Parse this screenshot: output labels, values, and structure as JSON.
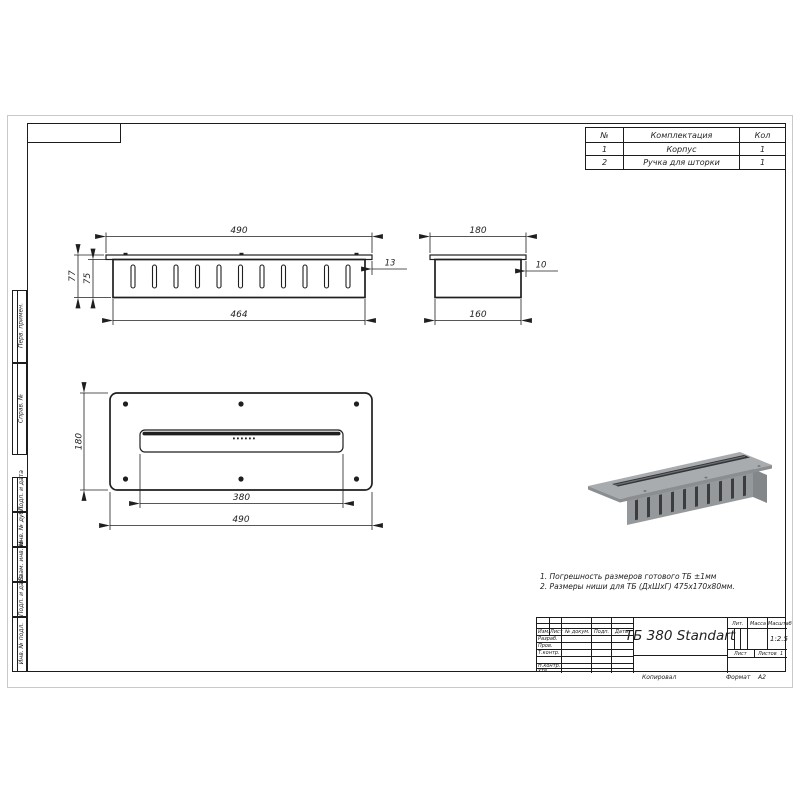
{
  "sheet": {
    "copied_label": "Копировал",
    "format_label": "Формат",
    "format_value": "А2"
  },
  "parts_table": {
    "col_num": "№",
    "col_name": "Комплектация",
    "col_qty": "Кол",
    "rows": [
      {
        "num": "1",
        "name": "Корпус",
        "qty": "1"
      },
      {
        "num": "2",
        "name": "Ручка для шторки",
        "qty": "1"
      }
    ]
  },
  "views": {
    "front": {
      "dim_overall": "490",
      "dim_body": "464",
      "dim_h_outer": "77",
      "dim_h_inner": "75",
      "dim_flange": "13"
    },
    "side": {
      "dim_overall": "180",
      "dim_body": "160",
      "dim_flange": "10"
    },
    "plan": {
      "dim_depth": "180",
      "dim_slot": "380",
      "dim_overall": "490"
    }
  },
  "notes": {
    "line1": "1. Погрешность размеров готового ТБ ±1мм",
    "line2": "2. Размеры ниши для ТБ (ДхШхГ) 475х170х80мм."
  },
  "title_block": {
    "title": "ТБ 380 Standart",
    "col_izm": "Изм.",
    "col_list": "Лист",
    "col_doc": "№ докум.",
    "col_sign": "Подп.",
    "col_date": "Дата",
    "row_razrab": "Разраб.",
    "row_prov": "Пров.",
    "row_tcontr": "Т.контр.",
    "row_ncontr": "Н.контр.",
    "row_utv": "Утв.",
    "lit_label": "Лит.",
    "mass_label": "Масса",
    "scale_label": "Масштаб",
    "scale_value": "1:2.5",
    "list_label": "Лист",
    "listov_label": "Листов",
    "listov_value": "1"
  },
  "side_stamp": {
    "labels": [
      "Перв. примен.",
      "Справ. №",
      "Подп. и дата",
      "Инв. № дубл.",
      "Взам. инв. №",
      "Подп. и дата",
      "Инв. № подл."
    ]
  },
  "colors": {
    "metal_top": "#a9acaf",
    "metal_front": "#96999c",
    "metal_side": "#84878a",
    "slot_dark": "#333537"
  }
}
